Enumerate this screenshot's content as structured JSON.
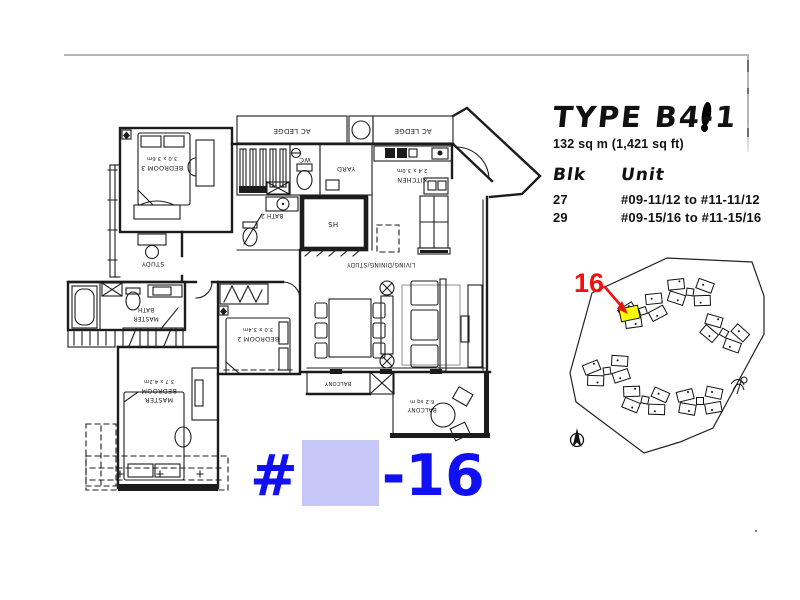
{
  "colors": {
    "stamp_blue": "#1010f2",
    "redaction_lavender": "#c6c6f8",
    "highlight_yellow": "#ffff00",
    "marker_red": "#ee1111",
    "page_border_gray": "#b6b6b6",
    "plan_line": "#1c1c1c"
  },
  "stamp": {
    "prefix": "#",
    "suffix": "-16"
  },
  "title_block": {
    "type": "TYPE B4-1",
    "area": "132 sq m (1,421 sq ft)",
    "col_blk": "Blk",
    "col_unit": "Unit",
    "rows": [
      {
        "blk": "27",
        "unit": "#09-11/12 to #11-11/12"
      },
      {
        "blk": "29",
        "unit": "#09-15/16 to #11-15/16"
      }
    ]
  },
  "site_map": {
    "highlight_label": "16"
  },
  "floor_plan": {
    "labels": {
      "ac_ledge_left": "AC LEDGE",
      "ac_ledge_right": "AC LEDGE",
      "wc": "WC",
      "yard": "YARD",
      "kitchen": "KITCHEN",
      "kitchen_dims": "2.4 x 3.0m",
      "bath2": "BATH 2",
      "hs": "HS",
      "living": "LIVING/DINING/STUDY",
      "study": "STUDY",
      "bedroom3": "BEDROOM 3",
      "bedroom3_dims": "3.0 x 3.6m",
      "bedroom2": "BEDROOM 2",
      "bedroom2_dims": "3.0 x 3.4m",
      "master_line1": "MASTER",
      "master_line2": "BEDROOM",
      "master_dims": "3.7 x 4.2m",
      "master_bath_line1": "MASTER",
      "master_bath_line2": "BATH",
      "balcony_left": "BALCONY",
      "balcony_right": "BALCONY",
      "balcony_right_dims": "6.2 sq m"
    }
  }
}
